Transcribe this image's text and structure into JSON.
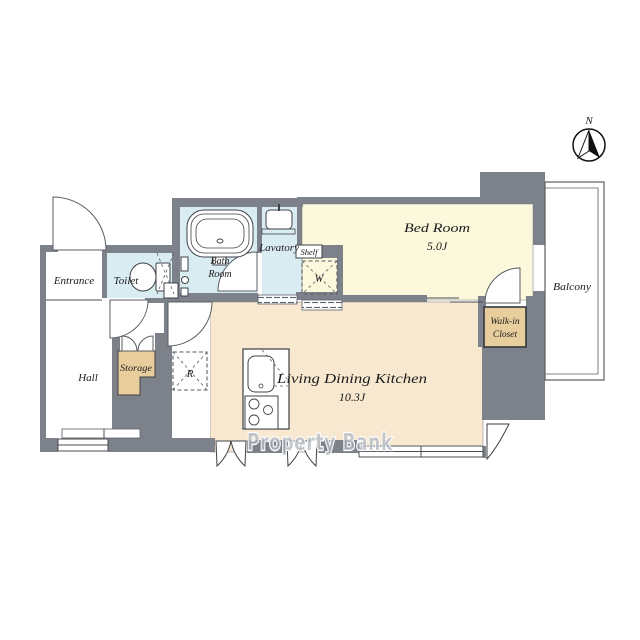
{
  "plan": {
    "type": "apartment-floor-plan",
    "rooms": {
      "entrance": {
        "label": "Entrance"
      },
      "toilet": {
        "label": "Toilet"
      },
      "bath_room": {
        "line1": "Bath",
        "line2": "Room"
      },
      "lavatory": {
        "label": "Lavatory"
      },
      "shelf": {
        "label": "Shelf"
      },
      "washer": {
        "label": "W"
      },
      "bed_room": {
        "label": "Bed Room",
        "size": "5.0J"
      },
      "balcony": {
        "label": "Balcony"
      },
      "walk_in_closet": {
        "line1": "Walk-in",
        "line2": "Closet"
      },
      "ldk": {
        "label": "Living Dining Kitchen",
        "size": "10.3J"
      },
      "hall": {
        "label": "Hall"
      },
      "storage": {
        "label": "Storage"
      },
      "refrigerator": {
        "label": "R"
      }
    },
    "compass": {
      "label": "N"
    },
    "watermark": {
      "text": "Property Bank"
    },
    "colors": {
      "wall": "#7d818a",
      "wet_area": "#d9ecf2",
      "bedroom": "#fbf8dc",
      "ldk": "#f8e8cf",
      "closet": "#e8cd9d",
      "line": "#4a4d52"
    }
  }
}
